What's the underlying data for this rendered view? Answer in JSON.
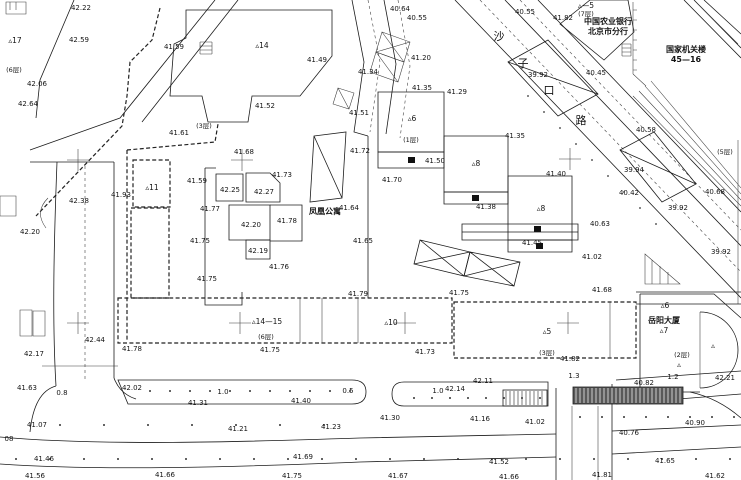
{
  "map": {
    "colors": {
      "ink": "#1c1c1c",
      "paper": "#ffffff",
      "hatch_dark": "#595959"
    },
    "street": {
      "name": "沙子口路",
      "chars": [
        {
          "t": "沙",
          "x": 499,
          "y": 40
        },
        {
          "t": "子",
          "x": 523,
          "y": 67
        },
        {
          "t": "口",
          "x": 549,
          "y": 94
        },
        {
          "t": "路",
          "x": 581,
          "y": 124
        }
      ]
    },
    "place_names": [
      {
        "t": "凤凰公寓",
        "x": 325,
        "y": 214
      },
      {
        "t": "中国农业银行",
        "x": 608,
        "y": 24
      },
      {
        "t": "北京市分行",
        "x": 608,
        "y": 34
      },
      {
        "t": "国家机关楼",
        "x": 686,
        "y": 52
      },
      {
        "t": "45—16",
        "x": 686,
        "y": 62
      },
      {
        "t": "岳阳大厦",
        "x": 664,
        "y": 323
      }
    ],
    "building_markers": [
      {
        "t": "▵17",
        "x": 15,
        "y": 43
      },
      {
        "t": "▵14",
        "x": 262,
        "y": 48
      },
      {
        "t": "▵11",
        "x": 152,
        "y": 190
      },
      {
        "t": "▵6",
        "x": 412,
        "y": 121
      },
      {
        "t": "▵8",
        "x": 476,
        "y": 166
      },
      {
        "t": "▵8",
        "x": 541,
        "y": 211
      },
      {
        "t": "▵14—15",
        "x": 267,
        "y": 324
      },
      {
        "t": "▵10",
        "x": 391,
        "y": 325
      },
      {
        "t": "▵5",
        "x": 547,
        "y": 334
      },
      {
        "t": "▵7",
        "x": 664,
        "y": 333
      },
      {
        "t": "▵6",
        "x": 665,
        "y": 308
      },
      {
        "t": "▵—5",
        "x": 586,
        "y": 8
      },
      {
        "t": "▵",
        "x": 713,
        "y": 348
      },
      {
        "t": "▵",
        "x": 679,
        "y": 367
      }
    ],
    "floor_labels": [
      {
        "t": "(6层)",
        "x": 14,
        "y": 72
      },
      {
        "t": "(3层)",
        "x": 204,
        "y": 128
      },
      {
        "t": "(7层)",
        "x": 586,
        "y": 16
      },
      {
        "t": "(1层)",
        "x": 411,
        "y": 142
      },
      {
        "t": "(5层)",
        "x": 725,
        "y": 154
      },
      {
        "t": "(6层)",
        "x": 266,
        "y": 339
      },
      {
        "t": "(3层)",
        "x": 547,
        "y": 355
      },
      {
        "t": "(2层)",
        "x": 682,
        "y": 357
      }
    ],
    "elevation_labels": [
      {
        "t": "42.22",
        "x": 81,
        "y": 10
      },
      {
        "t": "42.59",
        "x": 79,
        "y": 42
      },
      {
        "t": "42.06",
        "x": 37,
        "y": 86
      },
      {
        "t": "42.64",
        "x": 28,
        "y": 106
      },
      {
        "t": "41.59",
        "x": 174,
        "y": 49
      },
      {
        "t": "41.52",
        "x": 265,
        "y": 108
      },
      {
        "t": "41.61",
        "x": 179,
        "y": 135
      },
      {
        "t": "41.49",
        "x": 317,
        "y": 62
      },
      {
        "t": "40.64",
        "x": 400,
        "y": 11
      },
      {
        "t": "40.55",
        "x": 417,
        "y": 20
      },
      {
        "t": "41.34",
        "x": 368,
        "y": 74
      },
      {
        "t": "41.51",
        "x": 359,
        "y": 115
      },
      {
        "t": "41.20",
        "x": 421,
        "y": 60
      },
      {
        "t": "41.35",
        "x": 422,
        "y": 90
      },
      {
        "t": "41.29",
        "x": 457,
        "y": 94
      },
      {
        "t": "40.55",
        "x": 525,
        "y": 14
      },
      {
        "t": "41.82",
        "x": 563,
        "y": 20
      },
      {
        "t": "39.92",
        "x": 538,
        "y": 77
      },
      {
        "t": "40.45",
        "x": 596,
        "y": 75
      },
      {
        "t": "40.58",
        "x": 646,
        "y": 132
      },
      {
        "t": "39.94",
        "x": 634,
        "y": 172
      },
      {
        "t": "40.42",
        "x": 629,
        "y": 195
      },
      {
        "t": "40.68",
        "x": 715,
        "y": 194
      },
      {
        "t": "39.92",
        "x": 678,
        "y": 210
      },
      {
        "t": "40.63",
        "x": 600,
        "y": 226
      },
      {
        "t": "39.92",
        "x": 721,
        "y": 254
      },
      {
        "t": "41.72",
        "x": 360,
        "y": 153
      },
      {
        "t": "41.68",
        "x": 244,
        "y": 154
      },
      {
        "t": "41.73",
        "x": 282,
        "y": 177
      },
      {
        "t": "41.59",
        "x": 197,
        "y": 183
      },
      {
        "t": "41.70",
        "x": 392,
        "y": 182
      },
      {
        "t": "41.64",
        "x": 349,
        "y": 210
      },
      {
        "t": "42.25",
        "x": 230,
        "y": 192
      },
      {
        "t": "42.27",
        "x": 264,
        "y": 194
      },
      {
        "t": "41.77",
        "x": 210,
        "y": 211
      },
      {
        "t": "42.20",
        "x": 251,
        "y": 227
      },
      {
        "t": "41.78",
        "x": 287,
        "y": 223
      },
      {
        "t": "41.75",
        "x": 200,
        "y": 243
      },
      {
        "t": "42.19",
        "x": 258,
        "y": 253
      },
      {
        "t": "41.76",
        "x": 279,
        "y": 269
      },
      {
        "t": "41.75",
        "x": 207,
        "y": 281
      },
      {
        "t": "41.65",
        "x": 363,
        "y": 243
      },
      {
        "t": "41.50",
        "x": 435,
        "y": 163
      },
      {
        "t": "41.35",
        "x": 515,
        "y": 138
      },
      {
        "t": "41.40",
        "x": 556,
        "y": 176
      },
      {
        "t": "41.38",
        "x": 486,
        "y": 209
      },
      {
        "t": "41.45",
        "x": 532,
        "y": 245
      },
      {
        "t": "41.02",
        "x": 592,
        "y": 259
      },
      {
        "t": "41.68",
        "x": 602,
        "y": 292
      },
      {
        "t": "41.79",
        "x": 358,
        "y": 296
      },
      {
        "t": "41.75",
        "x": 459,
        "y": 295
      },
      {
        "t": "42.38",
        "x": 79,
        "y": 203
      },
      {
        "t": "41.93",
        "x": 121,
        "y": 197
      },
      {
        "t": "42.20",
        "x": 30,
        "y": 234
      },
      {
        "t": "42.17",
        "x": 34,
        "y": 356
      },
      {
        "t": "42.44",
        "x": 95,
        "y": 342
      },
      {
        "t": "41.78",
        "x": 132,
        "y": 351
      },
      {
        "t": "41.63",
        "x": 27,
        "y": 390
      },
      {
        "t": "42.02",
        "x": 132,
        "y": 390
      },
      {
        "t": "41.31",
        "x": 198,
        "y": 405
      },
      {
        "t": "41.07",
        "x": 37,
        "y": 427
      },
      {
        "t": "41.21",
        "x": 238,
        "y": 431
      },
      {
        "t": "08",
        "x": 9,
        "y": 441
      },
      {
        "t": "41.46",
        "x": 44,
        "y": 461
      },
      {
        "t": "41.56",
        "x": 35,
        "y": 478
      },
      {
        "t": "41.66",
        "x": 165,
        "y": 477
      },
      {
        "t": "41.69",
        "x": 303,
        "y": 459
      },
      {
        "t": "41.75",
        "x": 292,
        "y": 478
      },
      {
        "t": "41.75",
        "x": 270,
        "y": 352
      },
      {
        "t": "41.73",
        "x": 425,
        "y": 354
      },
      {
        "t": "41.40",
        "x": 301,
        "y": 403
      },
      {
        "t": "42.14",
        "x": 455,
        "y": 391
      },
      {
        "t": "42.11",
        "x": 483,
        "y": 383
      },
      {
        "t": "41.30",
        "x": 390,
        "y": 420
      },
      {
        "t": "41.16",
        "x": 480,
        "y": 421
      },
      {
        "t": "41.23",
        "x": 331,
        "y": 429
      },
      {
        "t": "41.67",
        "x": 398,
        "y": 478
      },
      {
        "t": "41.66",
        "x": 509,
        "y": 479
      },
      {
        "t": "41.52",
        "x": 499,
        "y": 464
      },
      {
        "t": "41.81",
        "x": 602,
        "y": 477
      },
      {
        "t": "41.62",
        "x": 715,
        "y": 478
      },
      {
        "t": "41.65",
        "x": 665,
        "y": 463
      },
      {
        "t": "40.76",
        "x": 629,
        "y": 435
      },
      {
        "t": "40.90",
        "x": 695,
        "y": 425
      },
      {
        "t": "41.02",
        "x": 535,
        "y": 424
      },
      {
        "t": "40.82",
        "x": 644,
        "y": 385
      },
      {
        "t": "42.21",
        "x": 725,
        "y": 380
      },
      {
        "t": "41.82",
        "x": 570,
        "y": 361
      }
    ],
    "dimension_labels": [
      {
        "t": "0.8",
        "x": 62,
        "y": 395
      },
      {
        "t": "1.0",
        "x": 223,
        "y": 394
      },
      {
        "t": "0.5",
        "x": 348,
        "y": 393
      },
      {
        "t": "1.0",
        "x": 438,
        "y": 393
      },
      {
        "t": "1.3",
        "x": 574,
        "y": 378
      },
      {
        "t": "1.2",
        "x": 673,
        "y": 379
      }
    ],
    "survey_crosses": [
      [
        78,
        160
      ],
      [
        242,
        160
      ],
      [
        570,
        159
      ],
      [
        78,
        323
      ],
      [
        240,
        323
      ],
      [
        405,
        323
      ],
      [
        568,
        323
      ]
    ],
    "symbols": {
      "tree_rows": [
        {
          "y": 391,
          "x0": 150,
          "x1": 350,
          "step": 20
        },
        {
          "y": 398,
          "x0": 414,
          "x1": 546,
          "step": 18
        },
        {
          "y": 417,
          "x0": 580,
          "x1": 738,
          "step": 22
        },
        {
          "y": 459,
          "x0": 16,
          "x1": 738,
          "step": 34
        },
        {
          "y": 425,
          "x0": 60,
          "x1": 360,
          "step": 44
        }
      ],
      "diag_dots": {
        "x0": 528,
        "y0": 96,
        "dx": 16,
        "dy": 16,
        "n": 9
      },
      "hatch_bars": [
        {
          "x": 503,
          "y": 390,
          "w": 44,
          "h": 16,
          "dark": false
        },
        {
          "x": 573,
          "y": 387,
          "w": 110,
          "h": 17,
          "dark": true
        }
      ]
    }
  }
}
